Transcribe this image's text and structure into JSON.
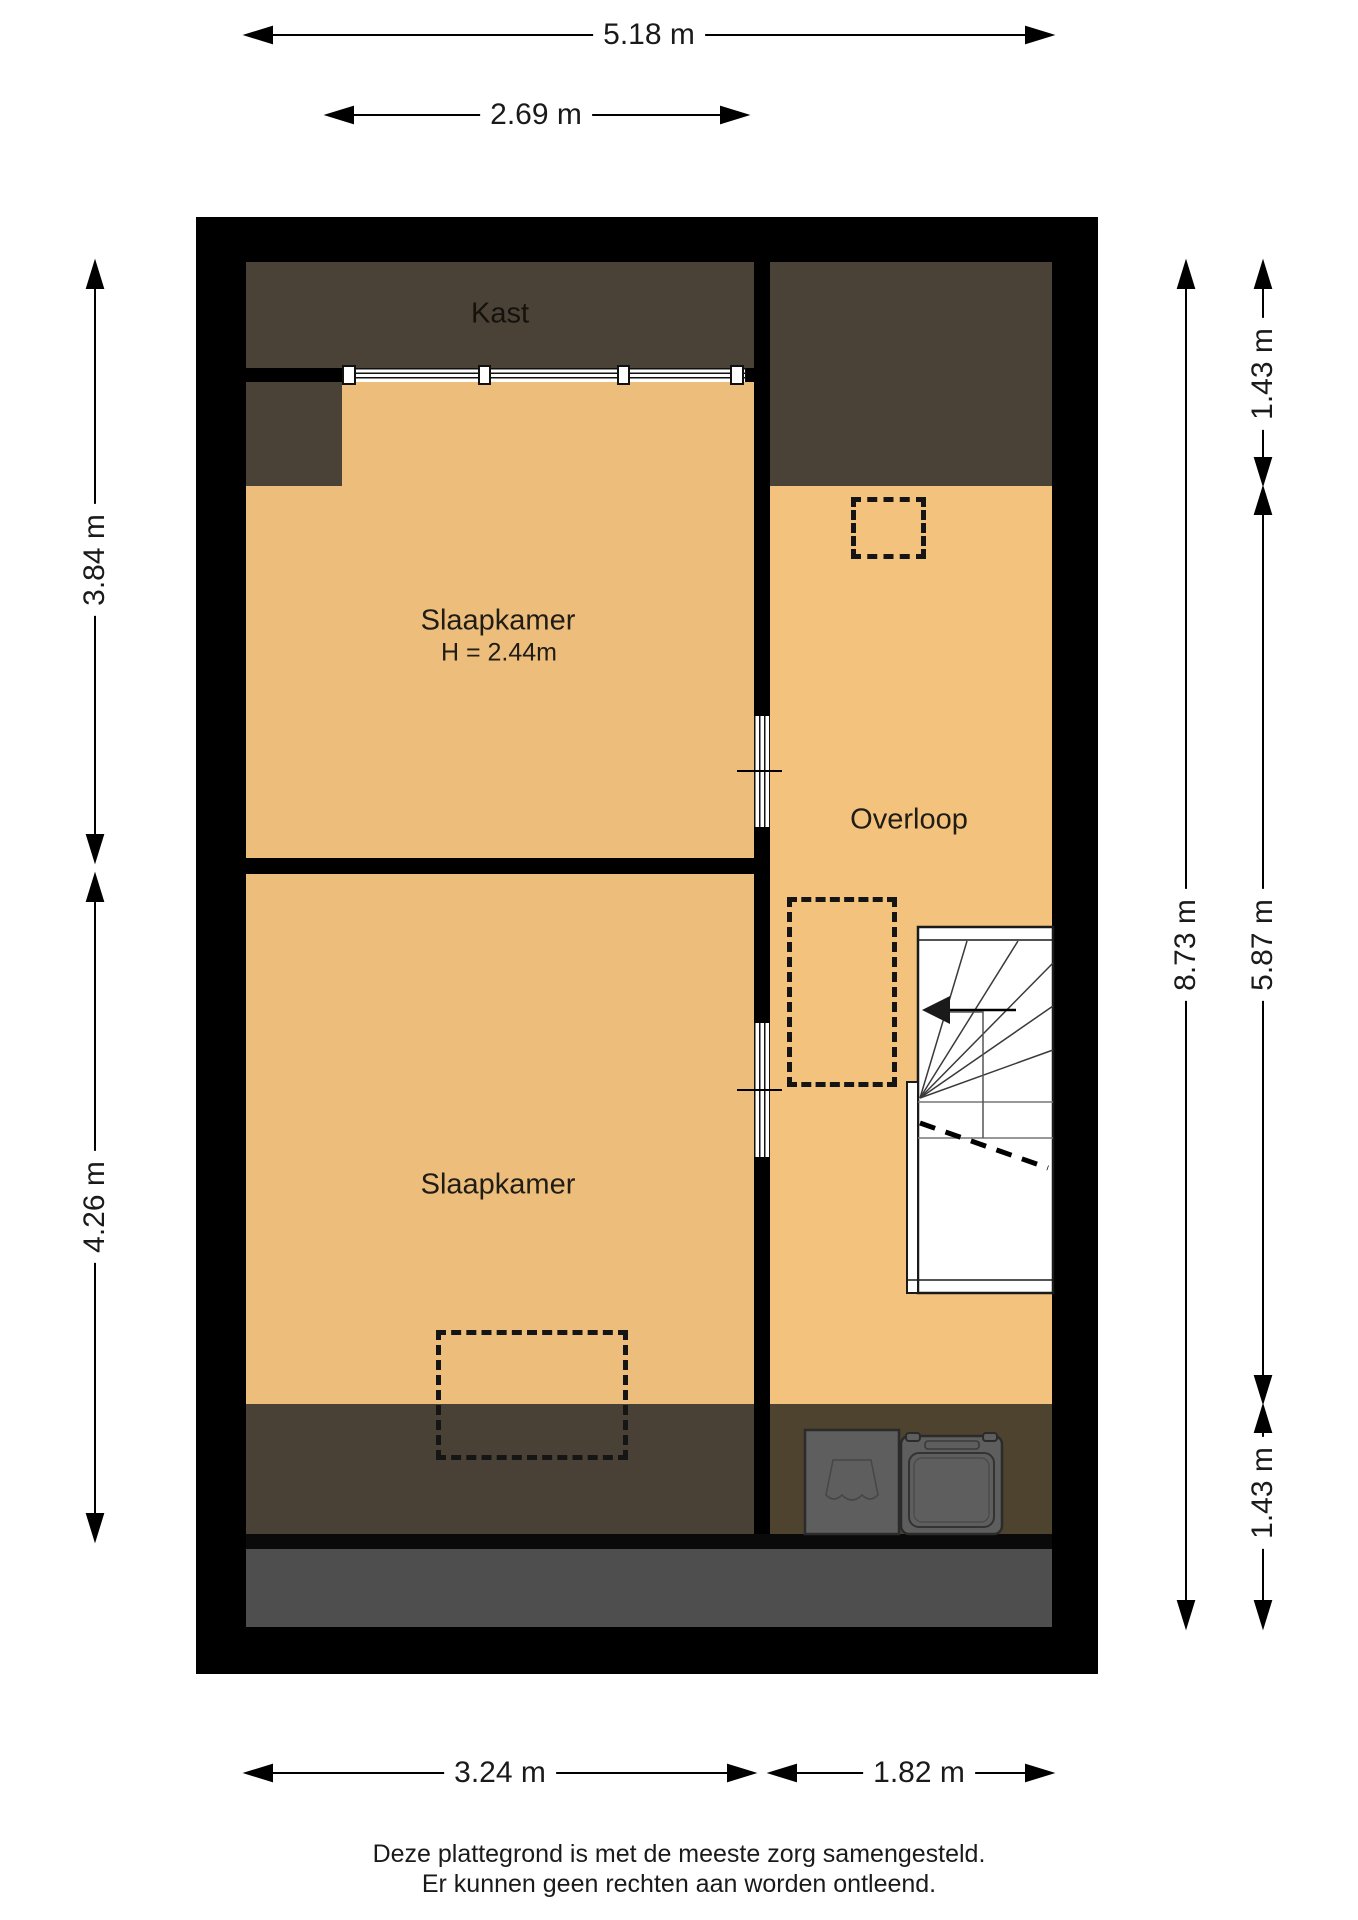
{
  "rooms": {
    "kast": {
      "label": "Kast"
    },
    "bedroom_top": {
      "label": "Slaapkamer",
      "height_note": "H = 2.44m"
    },
    "overloop": {
      "label": "Overloop"
    },
    "bedroom_bottom": {
      "label": "Slaapkamer"
    }
  },
  "dimensions": {
    "top_total": "5.18 m",
    "top_window": "2.69 m",
    "bottom_left": "3.24 m",
    "bottom_right": "1.82 m",
    "left_upper": "3.84 m",
    "left_lower": "4.26 m",
    "right_upper_small": "1.43 m",
    "right_total": "8.73 m",
    "right_middle": "5.87 m",
    "right_lower_small": "1.43 m"
  },
  "footer": {
    "line1": "Deze plattegrond is met de meeste zorg samengesteld.",
    "line2": "Er kunnen geen rechten aan worden ontleend."
  },
  "colors": {
    "wall": "#000000",
    "bedroom-floor": "#EDBE7B",
    "overloop-floor": "#F3C37E",
    "dark-zone": "#4B4237",
    "bottom-zone": "#4A4136",
    "under-stairs-zone": "#4E432E",
    "roof-edge": "#4E4E4E",
    "appliance": "#5E5E5E",
    "appliance-outline": "#2B2B2B",
    "text": "#1A1A1A"
  }
}
